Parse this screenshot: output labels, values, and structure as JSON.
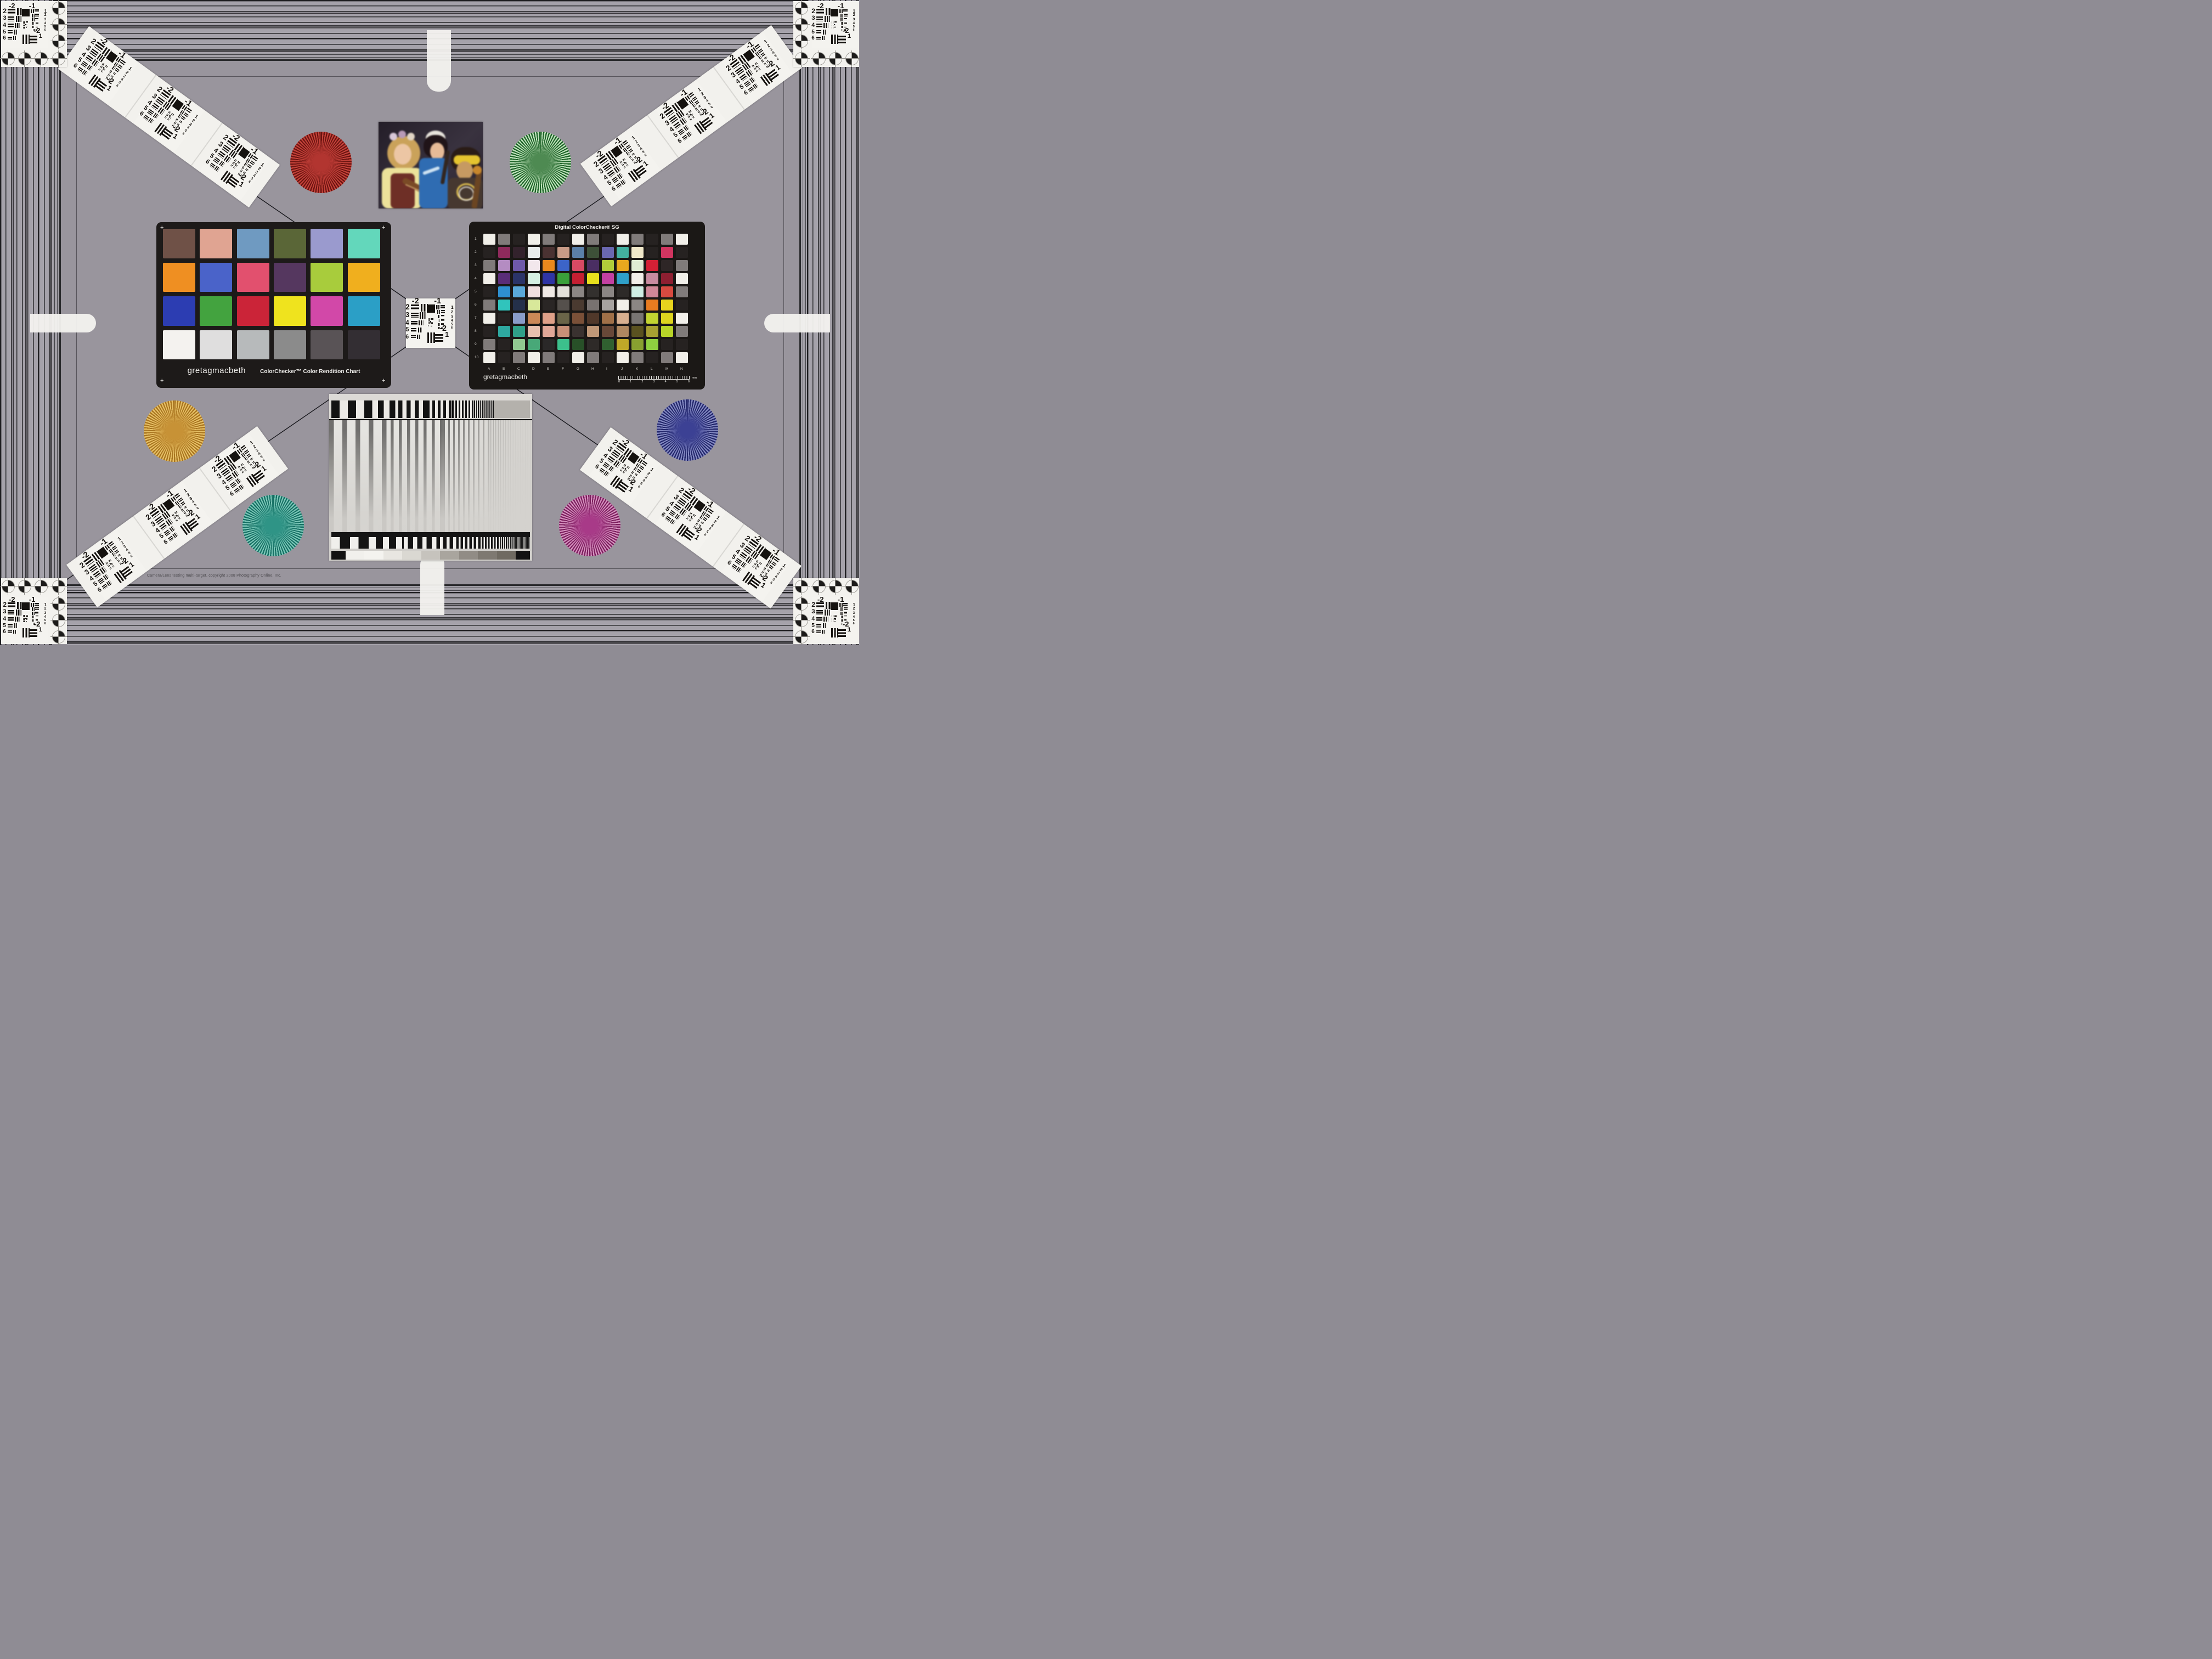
{
  "footer_note": "Camera/Lens testing multi-target, copyright 2008 Photography Online, Inc.",
  "usaf_target": {
    "top_left": "-2",
    "top_right": "-1",
    "left_column": [
      "2",
      "3",
      "4",
      "5",
      "6"
    ],
    "right_column": [
      "1",
      "2",
      "3",
      "4",
      "5",
      "6"
    ],
    "bottom_right": [
      "-2",
      "1"
    ]
  },
  "colorchecker": {
    "brand": "gretagmacbeth",
    "title": "ColorChecker™ Color Rendition Chart",
    "corner_mark": "+",
    "patches": [
      "#6f5147",
      "#e0a492",
      "#6f9ac1",
      "#5a6637",
      "#9a9ace",
      "#63d7bb",
      "#ef8f22",
      "#4a63c9",
      "#e2506e",
      "#55375f",
      "#a8cc3c",
      "#f0af1e",
      "#2c3db2",
      "#43a33f",
      "#cb2438",
      "#efe31e",
      "#d248a8",
      "#2b9fc6",
      "#f4f2ef",
      "#dfdede",
      "#b7babb",
      "#8b8b8b",
      "#595356",
      "#332e33"
    ]
  },
  "colorchecker_sg": {
    "title": "Digital ColorChecker® SG",
    "brand": "gretagmacbeth",
    "row_labels": [
      "1",
      "2",
      "3",
      "4",
      "5",
      "6",
      "7",
      "8",
      "9",
      "10"
    ],
    "col_labels": [
      "A",
      "B",
      "C",
      "D",
      "E",
      "F",
      "G",
      "H",
      "I",
      "J",
      "K",
      "L",
      "M",
      "N"
    ],
    "ruler": {
      "ticks": [
        "0",
        "1",
        "2",
        "3",
        "4",
        "5",
        "6"
      ],
      "unit": "mm"
    },
    "patch_rows": [
      [
        "#f1efe9",
        "#807b7a",
        "#262221",
        "#f1efe9",
        "#807b7a",
        "#262221",
        "#f1efe9",
        "#807b7a",
        "#262221",
        "#f1efe9",
        "#807b7a",
        "#262221",
        "#807b7a",
        "#f1efe9"
      ],
      [
        "#262221",
        "#8e2a5c",
        "#33222c",
        "#e9eceb",
        "#4a3232",
        "#c89b87",
        "#5b80a8",
        "#3d5038",
        "#6a68b0",
        "#43b1a0",
        "#f0e8c9",
        "#262221",
        "#d23560",
        "#262221"
      ],
      [
        "#807b7a",
        "#b48cc2",
        "#6f59a9",
        "#f2e7ec",
        "#e8891e",
        "#3c64c8",
        "#d84a64",
        "#4a2e62",
        "#b1cc3a",
        "#e8a81e",
        "#dfecd3",
        "#d42035",
        "#2e2626",
        "#807b7a"
      ],
      [
        "#f1efe9",
        "#5a2d78",
        "#2b3468",
        "#d5efe2",
        "#2f35a5",
        "#3aa03b",
        "#c51f32",
        "#e7df1d",
        "#c340a2",
        "#2fa0c8",
        "#f1efe9",
        "#c88ba0",
        "#8e1f31",
        "#f1efe9"
      ],
      [
        "#262221",
        "#2e8fd0",
        "#5aa8d8",
        "#f0dede",
        "#efe9e4",
        "#e3e0da",
        "#8b8684",
        "#33302e",
        "#8b8684",
        "#2d2a28",
        "#cfeee4",
        "#d08898",
        "#d84a40",
        "#807b7a"
      ],
      [
        "#807b7a",
        "#30c4bc",
        "#24304a",
        "#d8e89a",
        "#2a2625",
        "#55504c",
        "#4a3a30",
        "#787270",
        "#a7a3a0",
        "#f1efe9",
        "#8b8684",
        "#e87b20",
        "#e8d41e",
        "#262221"
      ],
      [
        "#f1efe9",
        "#262221",
        "#8a9cc8",
        "#cc8857",
        "#dfa088",
        "#6a6448",
        "#7a5038",
        "#50382a",
        "#a07048",
        "#d8b090",
        "#787472",
        "#c3d431",
        "#ddd41e",
        "#f1efe9"
      ],
      [
        "#262221",
        "#2ea8a0",
        "#30a088",
        "#e8c0ae",
        "#e0a898",
        "#c89078",
        "#3a3230",
        "#c09878",
        "#684838",
        "#b08860",
        "#5a5220",
        "#a8a032",
        "#b8d428",
        "#807b7a"
      ],
      [
        "#807b7a",
        "#262221",
        "#90c890",
        "#48a878",
        "#2a2828",
        "#3cc08c",
        "#285028",
        "#2e2a28",
        "#306030",
        "#c0a828",
        "#88a030",
        "#8fd040",
        "#262221",
        "#262221"
      ],
      [
        "#f1efe9",
        "#262221",
        "#807b7a",
        "#f1efe9",
        "#807b7a",
        "#262221",
        "#f1efe9",
        "#807b7a",
        "#262221",
        "#f1efe9",
        "#807b7a",
        "#262221",
        "#807b7a",
        "#f1efe9"
      ]
    ]
  },
  "starbursts": [
    {
      "name": "red-siemens-star",
      "dark": "#6b1410",
      "light": "#c4423a",
      "mid": "#b23530"
    },
    {
      "name": "green-siemens-star",
      "dark": "#1d6328",
      "light": "#bfe2bb",
      "mid": "#4e8a52"
    },
    {
      "name": "amber-siemens-star",
      "dark": "#a8741f",
      "light": "#e6c066",
      "mid": "#c79236"
    },
    {
      "name": "teal-siemens-star",
      "dark": "#156f63",
      "light": "#7cc7b8",
      "mid": "#2f9486"
    },
    {
      "name": "blue-siemens-star",
      "dark": "#23276b",
      "light": "#8389c2",
      "mid": "#3c4194"
    },
    {
      "name": "magenta-siemens-star",
      "dark": "#7c1f5e",
      "light": "#d490bd",
      "mid": "#a83a88"
    }
  ],
  "photo": {
    "description": "Portrait test photo — three costumed musicians with string instruments"
  },
  "sweep": {
    "gray_steps": [
      "#121212",
      "#f1f0ec",
      "#f4f3ef",
      "#e8e6e1",
      "#dad8d2",
      "#c6c3bd",
      "#a9a59e",
      "#918c85",
      "#7e7971",
      "#6f6a61",
      "#121212"
    ]
  },
  "palette": {
    "outer_band_bg": "#a5a2aa",
    "inner_bg": "#99959d",
    "card_black": "#1d1a19",
    "card_white": "#f3f2ee",
    "line_dark": "#17171c"
  }
}
